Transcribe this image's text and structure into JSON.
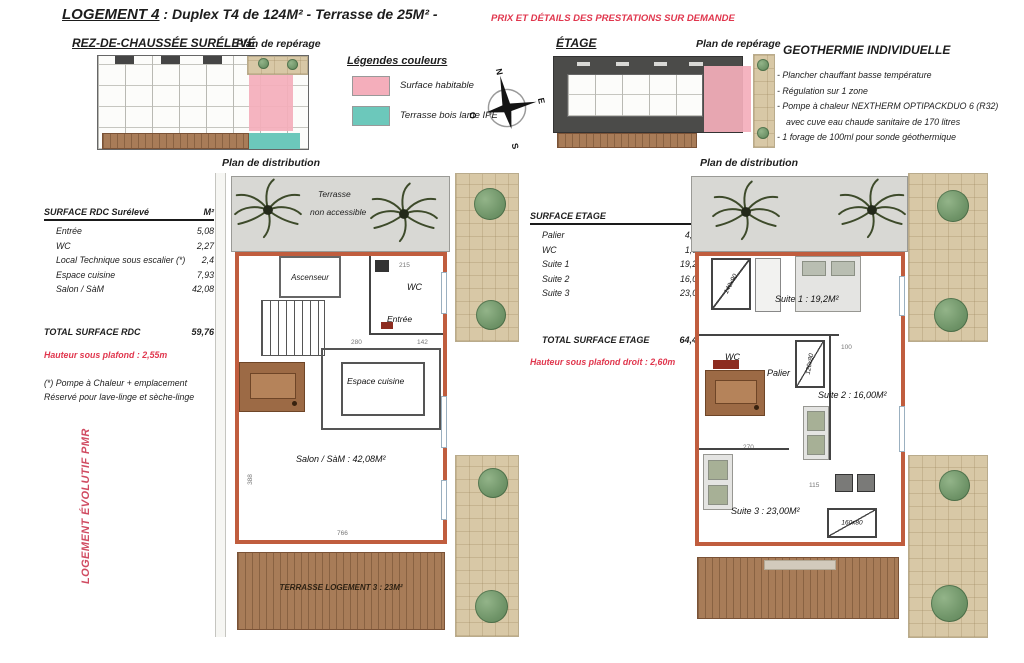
{
  "header": {
    "logement": "LOGEMENT 4",
    "subtitle": " :  Duplex T4 de 124M² - Terrasse de 25M²  -",
    "note": "PRIX ET DÉTAILS DES PRESTATIONS SUR DEMANDE"
  },
  "rdc": {
    "title": "REZ-DE-CHAUSSÉE SURÉLEVÉ",
    "reperage": "Plan de repérage",
    "distribution": "Plan de distribution"
  },
  "etage": {
    "title": "ÉTAGE",
    "reperage": "Plan de repérage",
    "distribution": "Plan de distribution"
  },
  "legend": {
    "title": "Légendes couleurs",
    "items": [
      {
        "label": "Surface habitable",
        "color": "#f4aebb"
      },
      {
        "label": "Terrasse bois lame IPE",
        "color": "#6cc8bb"
      }
    ]
  },
  "compass": {
    "n": "N",
    "e": "E",
    "s": "S",
    "o": "O"
  },
  "geothermie": {
    "title": "GEOTHERMIE INDIVIDUELLE",
    "lines": [
      "-  Plancher chauffant basse température",
      "-  Régulation sur 1 zone",
      "-  Pompe à chaleur NEXTHERM OPTIPACKDUO  6 (R32)",
      "avec cuve eau chaude sanitaire de 170 litres",
      "-  1 forage de 100ml pour sonde géothermique"
    ]
  },
  "rdc_table": {
    "title": "SURFACE RDC Surélevé",
    "unit": "M²",
    "rows": [
      {
        "label": "Entrée",
        "value": "5,08"
      },
      {
        "label": "WC",
        "value": "2,27"
      },
      {
        "label": "Local Technique sous escalier (*)",
        "value": "2,4"
      },
      {
        "label": "Espace cuisine",
        "value": "7,93"
      },
      {
        "label": "Salon / SàM",
        "value": "42,08"
      }
    ],
    "total_label": "TOTAL SURFACE RDC",
    "total_value": "59,76",
    "ceiling_note": "Hauteur sous plafond : 2,55m",
    "footnote1": "(*) Pompe à Chaleur + emplacement",
    "footnote2": "Réservé pour lave-linge et sèche-linge"
  },
  "etage_table": {
    "title": "SURFACE ETAGE",
    "unit": "M²",
    "rows": [
      {
        "label": "Palier",
        "value": "4,41"
      },
      {
        "label": "WC",
        "value": "1,81"
      },
      {
        "label": "Suite 1",
        "value": "19,20"
      },
      {
        "label": "Suite 2",
        "value": "16,00"
      },
      {
        "label": "Suite 3",
        "value": "23,00"
      }
    ],
    "total_label": "TOTAL SURFACE ETAGE",
    "total_value": "64,42",
    "ceiling_note": "Hauteur sous plafond droit : 2,60m"
  },
  "pmr": {
    "note": "LOGEMENT ÉVOLUTIF PMR"
  },
  "rdc_plan": {
    "terrace_line1": "Terrasse",
    "terrace_line2": "non accessible",
    "ascenseur": "Ascenseur",
    "wc": "WC",
    "entree": "Entrée",
    "cuisine": "Espace cuisine",
    "salon": "Salon / SàM : 42,08M²",
    "terrasse": "TERRASSE LOGEMENT 3 : 23M²",
    "dims": {
      "d215": "215",
      "d280": "280",
      "d142": "142",
      "d766": "766",
      "d388": "388"
    }
  },
  "etage_plan": {
    "suite1": "Suite 1 : 19,2M²",
    "wc": "WC",
    "palier": "Palier",
    "suite2": "Suite 2 : 16,00M²",
    "suite3": "Suite 3 : 23,00M²",
    "shower1": "140x90",
    "shower2": "120x80",
    "shower3": "160x80",
    "dims": {
      "d100": "100",
      "d270": "270",
      "d115": "115"
    }
  }
}
